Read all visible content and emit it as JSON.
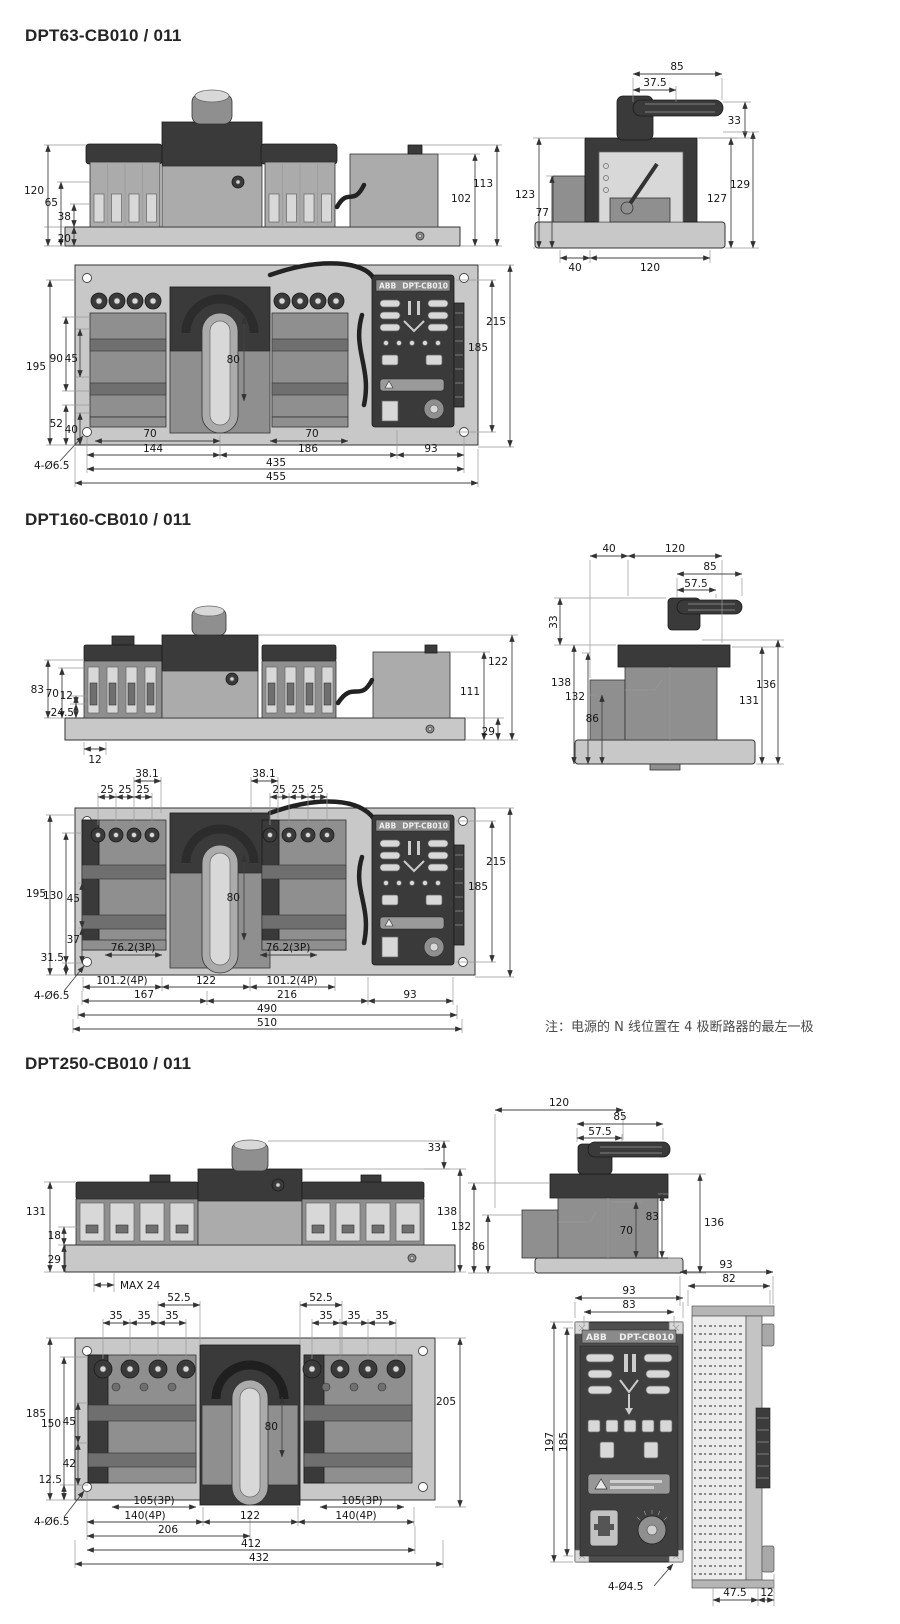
{
  "panel": {
    "brand": "ABB",
    "model": "DPT-CB010"
  },
  "dpt63": {
    "title": "DPT63-CB010 / 011",
    "front": {
      "d120": "120",
      "d65": "65",
      "d38": "38",
      "d20": "20",
      "d113": "113",
      "d102": "102"
    },
    "side": {
      "d85": "85",
      "d37_5": "37.5",
      "d33": "33",
      "d123": "123",
      "d77": "77",
      "d129": "129",
      "d127": "127",
      "d40": "40",
      "d120": "120"
    },
    "plan": {
      "d195": "195",
      "d90": "90",
      "d45": "45",
      "d52": "52",
      "d40": "40",
      "d80": "80",
      "d215": "215",
      "d185": "185",
      "d70": "70",
      "d144": "144",
      "d186": "186",
      "d93": "93",
      "d435": "435",
      "d455": "455",
      "holes": "4-Ø6.5"
    }
  },
  "dpt160": {
    "title": "DPT160-CB010 / 011",
    "front": {
      "d83": "83",
      "d70": "70",
      "d12": "12",
      "d24_5": "24.5",
      "b12": "12",
      "d122": "122",
      "d111": "111",
      "d29": "29"
    },
    "side": {
      "d40": "40",
      "d120": "120",
      "d85": "85",
      "d57_5": "57.5",
      "d33": "33",
      "d138": "138",
      "d132": "132",
      "d86": "86",
      "d131": "131",
      "d136": "136"
    },
    "plan": {
      "d38_1": "38.1",
      "d25": "25",
      "d195": "195",
      "d130": "130",
      "d45": "45",
      "d37": "37",
      "d31_5": "31.5",
      "d80": "80",
      "d215": "215",
      "d185": "185",
      "p3": "76.2(3P)",
      "p4": "101.2(4P)",
      "d122": "122",
      "d167": "167",
      "d216": "216",
      "d93": "93",
      "d490": "490",
      "d510": "510",
      "holes": "4-Ø6.5"
    },
    "note": "注：电源的 N 线位置在 4 极断路器的最左一极"
  },
  "dpt250": {
    "title": "DPT250-CB010 / 011",
    "front": {
      "d33": "33",
      "d131": "131",
      "d18": "18",
      "d29": "29",
      "d138": "138",
      "dmax": "MAX 24"
    },
    "side": {
      "d120": "120",
      "d85": "85",
      "d57_5": "57.5",
      "d132": "132",
      "d86": "86",
      "d70": "70",
      "d83": "83",
      "d136": "136"
    },
    "plan": {
      "d52_5": "52.5",
      "d35": "35",
      "d185": "185",
      "d150": "150",
      "d45": "45",
      "d42": "42",
      "d12_5": "12.5",
      "d80": "80",
      "d205": "205",
      "p3": "105(3P)",
      "p4": "140(4P)",
      "d122": "122",
      "d206": "206",
      "d412": "412",
      "d432": "432",
      "holes": "4-Ø6.5"
    },
    "ctrl_front": {
      "d93": "93",
      "d83": "83",
      "d197": "197",
      "d185": "185",
      "holes": "4-Ø4.5"
    },
    "ctrl_side": {
      "d93": "93",
      "d82": "82",
      "d47_5": "47.5",
      "d12": "12"
    }
  }
}
